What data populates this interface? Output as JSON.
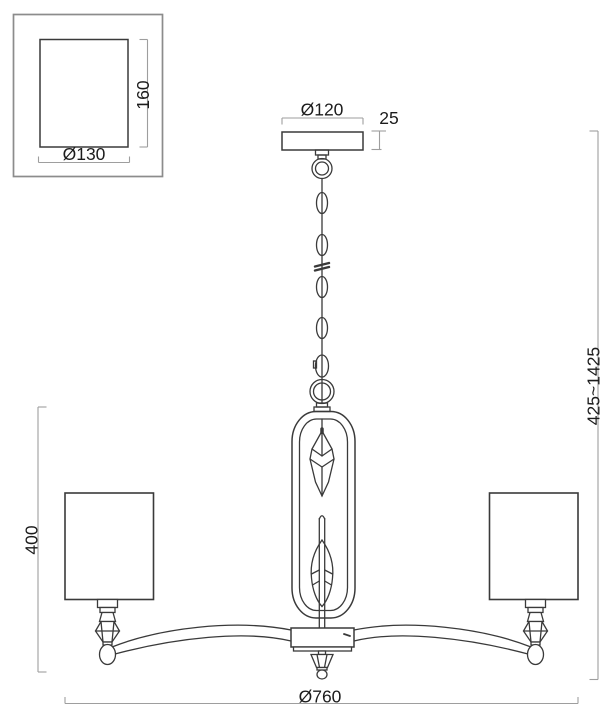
{
  "page": {
    "title": "Chandelier dimensional line drawing"
  },
  "labels": {
    "shade_diameter": "Ø130",
    "shade_height": "160",
    "canopy_diameter": "Ø120",
    "canopy_height": "25",
    "overall_height": "425~1425",
    "body_height": "400",
    "fixture_diameter": "Ø760"
  },
  "colors": {
    "line": "#3a3a3a",
    "dimension": "#9e9e9e",
    "text": "#1c1c1c",
    "frame": "#8c8c8c",
    "background": "#ffffff"
  }
}
